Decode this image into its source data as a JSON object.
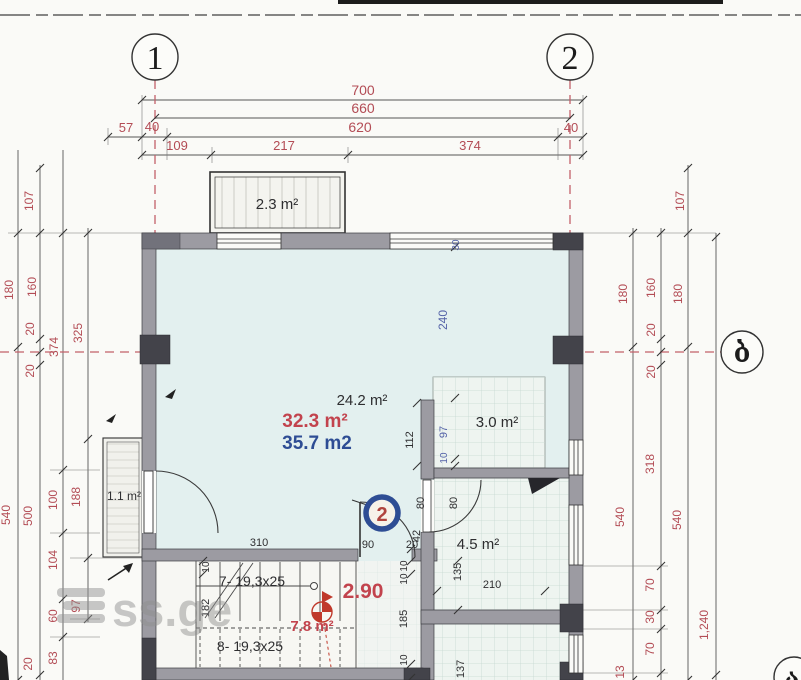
{
  "axis_bubbles": {
    "b1": "1",
    "b2": "2",
    "b_right": "ბ",
    "b_corner": "ა"
  },
  "callout": {
    "number": "2"
  },
  "watermark": {
    "text": "ss.ge"
  },
  "colors": {
    "wall_gray": "#9c9ba2",
    "column_dark": "#43434a",
    "room_fill": "#e3f0ef",
    "tile_fill": "#eef4f0",
    "dim_red": "#b34c55",
    "dim_blue": "#5563a8",
    "area_red": "#c2434d",
    "area_blue": "#2e4d94",
    "callout_ring": "#2e4d94",
    "watermark_gray": "#8f8f8f"
  },
  "dim_labels": [
    {
      "t": "700",
      "x": 363,
      "y": 95,
      "r": 0,
      "c": "red",
      "s": 14
    },
    {
      "t": "660",
      "x": 363,
      "y": 113,
      "r": 0,
      "c": "red",
      "s": 14
    },
    {
      "t": "57",
      "x": 126,
      "y": 132,
      "r": 0,
      "c": "red",
      "s": 13
    },
    {
      "t": "40",
      "x": 152,
      "y": 131,
      "r": 0,
      "c": "red",
      "s": 13
    },
    {
      "t": "620",
      "x": 360,
      "y": 132,
      "r": 0,
      "c": "red",
      "s": 14
    },
    {
      "t": "40",
      "x": 571,
      "y": 132,
      "r": 0,
      "c": "red",
      "s": 13
    },
    {
      "t": "109",
      "x": 177,
      "y": 150,
      "r": 0,
      "c": "red",
      "s": 13
    },
    {
      "t": "217",
      "x": 284,
      "y": 150,
      "r": 0,
      "c": "red",
      "s": 13
    },
    {
      "t": "374",
      "x": 470,
      "y": 150,
      "r": 0,
      "c": "red",
      "s": 13
    },
    {
      "t": "107",
      "x": 33,
      "y": 201,
      "r": -90,
      "c": "red",
      "s": 12
    },
    {
      "t": "180",
      "x": 13,
      "y": 290,
      "r": -90,
      "c": "red",
      "s": 12
    },
    {
      "t": "160",
      "x": 36,
      "y": 287,
      "r": -90,
      "c": "red",
      "s": 12
    },
    {
      "t": "20",
      "x": 34,
      "y": 329,
      "r": -90,
      "c": "red",
      "s": 12
    },
    {
      "t": "374",
      "x": 58,
      "y": 347,
      "r": -90,
      "c": "red",
      "s": 12
    },
    {
      "t": "325",
      "x": 82,
      "y": 333,
      "r": -90,
      "c": "red",
      "s": 12
    },
    {
      "t": "20",
      "x": 34,
      "y": 371,
      "r": -90,
      "c": "red",
      "s": 12
    },
    {
      "t": "540",
      "x": 10,
      "y": 515,
      "r": -90,
      "c": "red",
      "s": 12
    },
    {
      "t": "500",
      "x": 32,
      "y": 516,
      "r": -90,
      "c": "red",
      "s": 12
    },
    {
      "t": "100",
      "x": 57,
      "y": 500,
      "r": -90,
      "c": "red",
      "s": 12
    },
    {
      "t": "188",
      "x": 80,
      "y": 497,
      "r": -90,
      "c": "red",
      "s": 12
    },
    {
      "t": "104",
      "x": 57,
      "y": 560,
      "r": -90,
      "c": "red",
      "s": 12
    },
    {
      "t": "60",
      "x": 57,
      "y": 616,
      "r": -90,
      "c": "red",
      "s": 12
    },
    {
      "t": "97",
      "x": 80,
      "y": 606,
      "r": -90,
      "c": "red",
      "s": 12
    },
    {
      "t": "83",
      "x": 57,
      "y": 658,
      "r": -90,
      "c": "red",
      "s": 12
    },
    {
      "t": "20",
      "x": 32,
      "y": 664,
      "r": -90,
      "c": "red",
      "s": 12
    },
    {
      "t": "107",
      "x": 684,
      "y": 201,
      "r": -90,
      "c": "red",
      "s": 12
    },
    {
      "t": "180",
      "x": 627,
      "y": 294,
      "r": -90,
      "c": "red",
      "s": 12
    },
    {
      "t": "160",
      "x": 655,
      "y": 288,
      "r": -90,
      "c": "red",
      "s": 12
    },
    {
      "t": "20",
      "x": 655,
      "y": 330,
      "r": -90,
      "c": "red",
      "s": 12
    },
    {
      "t": "20",
      "x": 655,
      "y": 372,
      "r": -90,
      "c": "red",
      "s": 12
    },
    {
      "t": "180",
      "x": 682,
      "y": 294,
      "r": -90,
      "c": "red",
      "s": 12
    },
    {
      "t": "318",
      "x": 654,
      "y": 464,
      "r": -90,
      "c": "red",
      "s": 12
    },
    {
      "t": "540",
      "x": 624,
      "y": 517,
      "r": -90,
      "c": "red",
      "s": 12
    },
    {
      "t": "540",
      "x": 681,
      "y": 520,
      "r": -90,
      "c": "red",
      "s": 12
    },
    {
      "t": "70",
      "x": 654,
      "y": 585,
      "r": -90,
      "c": "red",
      "s": 12
    },
    {
      "t": "30",
      "x": 654,
      "y": 617,
      "r": -90,
      "c": "red",
      "s": 12
    },
    {
      "t": "70",
      "x": 654,
      "y": 649,
      "r": -90,
      "c": "red",
      "s": 12
    },
    {
      "t": "1,240",
      "x": 708,
      "y": 625,
      "r": -90,
      "c": "red",
      "s": 12
    },
    {
      "t": "13",
      "x": 624,
      "y": 672,
      "r": -90,
      "c": "red",
      "s": 12
    },
    {
      "t": "30",
      "x": 459,
      "y": 245,
      "r": -90,
      "c": "blue",
      "s": 10
    },
    {
      "t": "240",
      "x": 447,
      "y": 320,
      "r": -90,
      "c": "blue",
      "s": 12
    },
    {
      "t": "97",
      "x": 447,
      "y": 432,
      "r": -90,
      "c": "blue",
      "s": 11
    },
    {
      "t": "10",
      "x": 447,
      "y": 458,
      "r": -90,
      "c": "blue",
      "s": 10
    },
    {
      "t": "112",
      "x": 413,
      "y": 440,
      "r": -90,
      "c": "dark",
      "s": 11
    },
    {
      "t": "310",
      "x": 259,
      "y": 546,
      "r": 0,
      "c": "dark",
      "s": 11
    },
    {
      "t": "90",
      "x": 368,
      "y": 548,
      "r": 0,
      "c": "dark",
      "s": 11
    },
    {
      "t": "20",
      "x": 412,
      "y": 548,
      "r": 0,
      "c": "dark",
      "s": 11
    },
    {
      "t": "42",
      "x": 420,
      "y": 536,
      "r": -90,
      "c": "dark",
      "s": 11
    },
    {
      "t": "80",
      "x": 424,
      "y": 503,
      "r": -90,
      "c": "dark",
      "s": 11
    },
    {
      "t": "80",
      "x": 457,
      "y": 503,
      "r": -90,
      "c": "dark",
      "s": 11
    },
    {
      "t": "10",
      "x": 407,
      "y": 566,
      "r": -90,
      "c": "dark",
      "s": 10
    },
    {
      "t": "10",
      "x": 407,
      "y": 579,
      "r": -90,
      "c": "dark",
      "s": 10
    },
    {
      "t": "185",
      "x": 407,
      "y": 619,
      "r": -90,
      "c": "dark",
      "s": 11
    },
    {
      "t": "10",
      "x": 407,
      "y": 660,
      "r": -90,
      "c": "dark",
      "s": 10
    },
    {
      "t": "135",
      "x": 461,
      "y": 572,
      "r": -90,
      "c": "dark",
      "s": 11
    },
    {
      "t": "210",
      "x": 492,
      "y": 588,
      "r": 0,
      "c": "dark",
      "s": 11
    },
    {
      "t": "137",
      "x": 464,
      "y": 669,
      "r": -90,
      "c": "dark",
      "s": 11
    },
    {
      "t": "10",
      "x": 209,
      "y": 567,
      "r": -90,
      "c": "dark",
      "s": 10
    },
    {
      "t": "182",
      "x": 209,
      "y": 608,
      "r": -90,
      "c": "dark",
      "s": 11
    }
  ],
  "room_labels": [
    {
      "t": "2.3 m²",
      "x": 277,
      "y": 209,
      "c": "dark",
      "s": 15
    },
    {
      "t": "24.2 m²",
      "x": 362,
      "y": 405,
      "c": "dark",
      "s": 15
    },
    {
      "t": "32.3 m²",
      "x": 315,
      "y": 427,
      "c": "red-bold",
      "s": 19
    },
    {
      "t": "35.7 m2",
      "x": 317,
      "y": 449,
      "c": "blue-bold",
      "s": 19
    },
    {
      "t": "3.0 m²",
      "x": 497,
      "y": 427,
      "c": "dark",
      "s": 15
    },
    {
      "t": "4.5 m²",
      "x": 478,
      "y": 549,
      "c": "dark",
      "s": 15
    },
    {
      "t": "1.1 m²",
      "x": 124,
      "y": 500,
      "c": "dark",
      "s": 12
    },
    {
      "t": "2.90",
      "x": 363,
      "y": 598,
      "c": "red-bold",
      "s": 21
    },
    {
      "t": "7.8 m²",
      "x": 312,
      "y": 631,
      "c": "red-bold",
      "s": 15
    },
    {
      "t": "7- 19,3x25",
      "x": 252,
      "y": 586,
      "c": "dark",
      "s": 14
    },
    {
      "t": "8- 19,3x25",
      "x": 250,
      "y": 651,
      "c": "dark",
      "s": 14
    }
  ]
}
